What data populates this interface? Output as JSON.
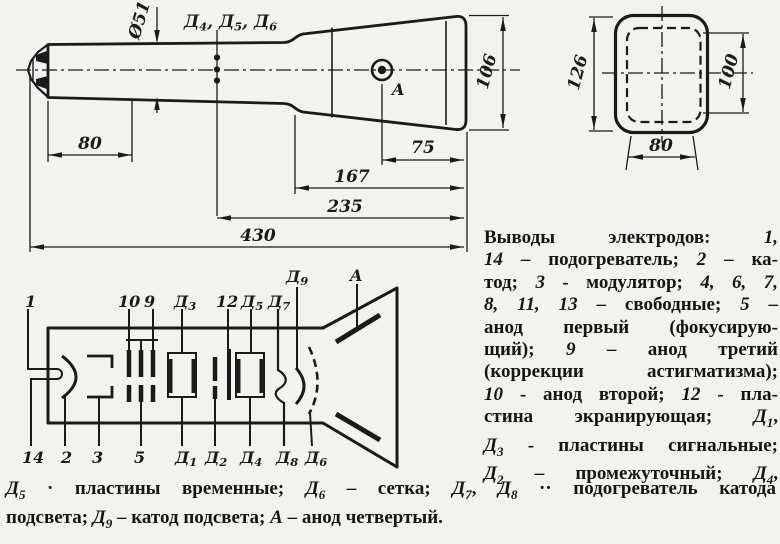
{
  "colors": {
    "paper": "#f2f2ee",
    "ink": "#1a1a1a"
  },
  "side_view": {
    "dims": {
      "dia": "Ø51",
      "len80": "80",
      "len75": "75",
      "len167": "167",
      "len235": "235",
      "len430": "430",
      "h106": "106"
    },
    "plates": [
      "Д",
      "4",
      ", Д",
      "5",
      ", Д",
      "6"
    ],
    "anode_label": "A"
  },
  "front_view": {
    "dims": {
      "h126": "126",
      "h100": "100",
      "w80": "80"
    }
  },
  "schematic": {
    "top_labels": [
      {
        "main": "1"
      },
      {
        "main": "10"
      },
      {
        "main": "9"
      },
      {
        "main": "Д",
        "sub": "3"
      },
      {
        "main": "12"
      },
      {
        "main": "Д",
        "sub": "5"
      },
      {
        "main": "Д",
        "sub": "7"
      },
      {
        "main": "Д",
        "sub": "9"
      },
      {
        "main": "A"
      }
    ],
    "bottom_labels": [
      {
        "main": "14"
      },
      {
        "main": "2"
      },
      {
        "main": "3"
      },
      {
        "main": "5"
      },
      {
        "main": "Д",
        "sub": "1"
      },
      {
        "main": "Д",
        "sub": "2"
      },
      {
        "main": "Д",
        "sub": "4"
      },
      {
        "main": "Д",
        "sub": "8"
      },
      {
        "main": "Д",
        "sub": "6"
      }
    ]
  },
  "caption": {
    "right_lines": [
      [
        {
          "t": "Выводы электродов: "
        },
        {
          "t": "1,",
          "i": 1
        }
      ],
      [
        {
          "t": "14",
          "i": 1
        },
        {
          "t": " – подогреватель; "
        },
        {
          "t": "2",
          "i": 1
        },
        {
          "t": " – ка-"
        }
      ],
      [
        {
          "t": "тод; "
        },
        {
          "t": "3",
          "i": 1
        },
        {
          "t": " - модулятор; "
        },
        {
          "t": "4, 6, 7,",
          "i": 1
        }
      ],
      [
        {
          "t": "8, 11, 13",
          "i": 1
        },
        {
          "t": " – свободные; "
        },
        {
          "t": "5",
          "i": 1
        },
        {
          "t": " –"
        }
      ],
      [
        {
          "t": "анод первый (фокусирую-"
        }
      ],
      [
        {
          "t": "щий); "
        },
        {
          "t": "9",
          "i": 1
        },
        {
          "t": " – анод третий"
        }
      ],
      [
        {
          "t": "(коррекции астигматизма);"
        }
      ],
      [
        {
          "t": "10",
          "i": 1
        },
        {
          "t": " - анод второй; "
        },
        {
          "t": "12",
          "i": 1
        },
        {
          "t": " - пла-"
        }
      ],
      [
        {
          "t": "стина экранирующая; "
        },
        {
          "t": "Д",
          "i": 1
        },
        {
          "t": "1",
          "s": 1
        },
        {
          "t": ","
        }
      ],
      [
        {
          "t": "Д",
          "i": 1
        },
        {
          "t": "3",
          "s": 1
        },
        {
          "t": " - пластины сигнальные;"
        }
      ],
      [
        {
          "t": "Д",
          "i": 1
        },
        {
          "t": "2",
          "s": 1
        },
        {
          "t": " – промежуточный; "
        },
        {
          "t": "Д",
          "i": 1
        },
        {
          "t": "4",
          "s": 1
        },
        {
          "t": ","
        }
      ]
    ],
    "bottom_lines": [
      [
        {
          "t": "Д",
          "i": 1
        },
        {
          "t": "5",
          "s": 1
        },
        {
          "t": " · пластины временные; "
        },
        {
          "t": "Д",
          "i": 1
        },
        {
          "t": "6",
          "s": 1
        },
        {
          "t": " – сетка; "
        },
        {
          "t": "Д",
          "i": 1
        },
        {
          "t": "7",
          "s": 1
        },
        {
          "t": ", "
        },
        {
          "t": "Д",
          "i": 1
        },
        {
          "t": "8",
          "s": 1
        },
        {
          "t": " ·· подогреватель катода"
        }
      ],
      [
        {
          "t": "подсвета; "
        },
        {
          "t": "Д",
          "i": 1
        },
        {
          "t": "9",
          "s": 1
        },
        {
          "t": " – катод подсвета; "
        },
        {
          "t": "А",
          "i": 1
        },
        {
          "t": " – анод четвертый."
        }
      ]
    ]
  }
}
